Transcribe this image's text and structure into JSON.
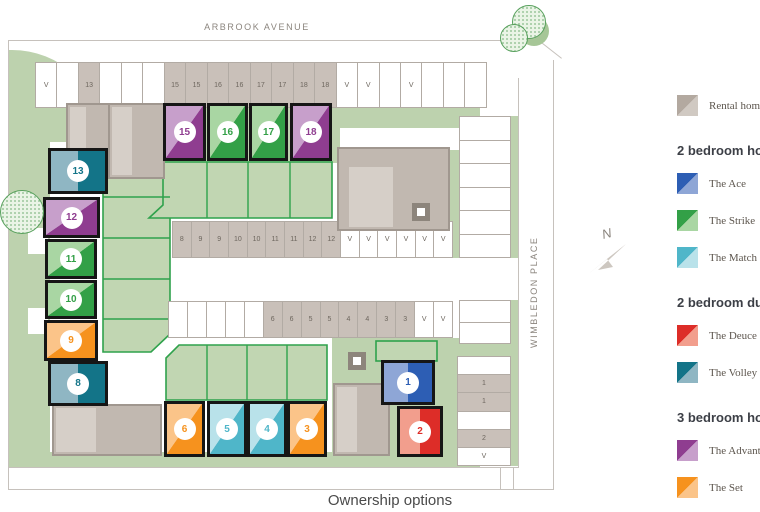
{
  "streets": {
    "top": "ARBROOK AVENUE",
    "right": "WIMBLEDON PLACE"
  },
  "compass": {
    "north_label": "N"
  },
  "footer": {
    "heading": "Ownership options"
  },
  "legend": {
    "rental": {
      "label": "Rental homes",
      "dark": "#b3a9a0",
      "light": "#d0c9c2"
    },
    "sections": [
      {
        "heading": "2 bedroom homes",
        "items": [
          {
            "label": "The Ace",
            "type": "ace"
          },
          {
            "label": "The Strike",
            "type": "strike"
          },
          {
            "label": "The Match",
            "type": "match"
          }
        ]
      },
      {
        "heading": "2 bedroom duplex",
        "items": [
          {
            "label": "The Deuce",
            "type": "deuce"
          },
          {
            "label": "The Volley",
            "type": "volley"
          }
        ]
      },
      {
        "heading": "3 bedroom homes",
        "items": [
          {
            "label": "The Advantage",
            "type": "advantage"
          },
          {
            "label": "The Set",
            "type": "set"
          }
        ]
      }
    ]
  },
  "plot_types": {
    "ace": {
      "name": "The Ace",
      "dark": "#2d5eb4",
      "light": "#8ea6d6"
    },
    "strike": {
      "name": "The Strike",
      "dark": "#33a047",
      "light": "#a9d6a3"
    },
    "match": {
      "name": "The Match",
      "dark": "#4fb6c9",
      "light": "#b9e2ea"
    },
    "deuce": {
      "name": "The Deuce",
      "dark": "#dd2d28",
      "light": "#f29e8d"
    },
    "volley": {
      "name": "The Volley",
      "dark": "#137488",
      "light": "#8fb6c3"
    },
    "advantage": {
      "name": "The Advantage",
      "dark": "#8f3d90",
      "light": "#c79fcb"
    },
    "set": {
      "name": "The Set",
      "dark": "#f6921e",
      "light": "#fbc489"
    }
  },
  "plots": [
    {
      "num": "1",
      "type": "ace"
    },
    {
      "num": "2",
      "type": "deuce"
    },
    {
      "num": "3",
      "type": "set"
    },
    {
      "num": "4",
      "type": "match"
    },
    {
      "num": "5",
      "type": "match"
    },
    {
      "num": "6",
      "type": "set"
    },
    {
      "num": "8",
      "type": "volley"
    },
    {
      "num": "9",
      "type": "set"
    },
    {
      "num": "10",
      "type": "strike"
    },
    {
      "num": "11",
      "type": "strike"
    },
    {
      "num": "12",
      "type": "advantage"
    },
    {
      "num": "13",
      "type": "volley"
    },
    {
      "num": "15",
      "type": "advantage"
    },
    {
      "num": "16",
      "type": "strike"
    },
    {
      "num": "17",
      "type": "strike"
    },
    {
      "num": "18",
      "type": "advantage"
    }
  ],
  "parking": {
    "top": [
      "V",
      "",
      "13",
      "",
      "",
      "",
      "15",
      "15",
      "16",
      "16",
      "17",
      "17",
      "18",
      "18",
      "V",
      "V",
      "",
      "V",
      "",
      "",
      ""
    ],
    "mid_upper": [
      "8",
      "9",
      "9",
      "10",
      "10",
      "11",
      "11",
      "12",
      "12",
      "V",
      "V",
      "V",
      "V",
      "V",
      "V"
    ],
    "mid_lower": [
      "",
      "",
      "",
      "",
      "",
      "6",
      "6",
      "5",
      "5",
      "4",
      "4",
      "3",
      "3",
      "V",
      "V"
    ],
    "right_upper": [
      "",
      "",
      "",
      "",
      "",
      ""
    ],
    "right_mid": [
      "",
      ""
    ],
    "right_lower": [
      "",
      "1",
      "1",
      "",
      "2",
      "V"
    ]
  }
}
